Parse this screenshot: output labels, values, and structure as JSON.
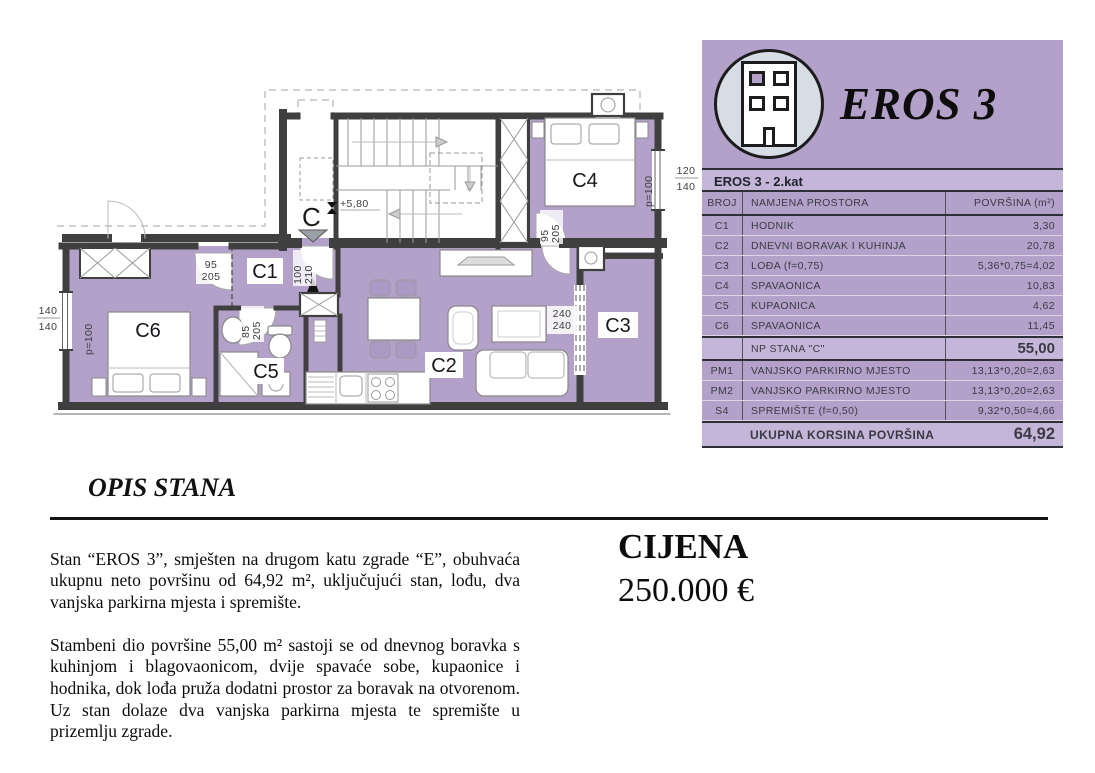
{
  "colors": {
    "purple": "#b3a1ca",
    "purple_light": "#c4b6d8",
    "wall": "#3f3f3f",
    "icon_circle_bg": "#d8dce5"
  },
  "floor_plan": {
    "room_labels": {
      "c1": "C1",
      "c2": "C2",
      "c3": "C3",
      "c4": "C4",
      "c5": "C5",
      "c6": "C6"
    },
    "entrance": {
      "letter": "C",
      "level": "+5,80"
    },
    "dims": {
      "c1_w": "95",
      "c1_h": "205",
      "entry_w": "100",
      "entry_h": "210",
      "c5_w": "85",
      "c5_h": "205",
      "c4_w": "95",
      "c4_h": "205",
      "c3_w": "240",
      "c3_h": "240",
      "win_left_a": "140",
      "win_left_b": "140",
      "win_right_a": "120",
      "win_right_b": "140",
      "p_left": "p=100",
      "p_right": "p=100"
    }
  },
  "panel": {
    "brand": "EROS 3",
    "subtitle": "EROS 3 - 2.kat",
    "table": {
      "headers": {
        "broj": "BROJ",
        "namjena": "NAMJENA PROSTORA",
        "povrsina": "POVRŠINA (m²)"
      },
      "rows": [
        {
          "broj": "C1",
          "namjena": "HODNIK",
          "povrsina": "3,30"
        },
        {
          "broj": "C2",
          "namjena": "DNEVNI BORAVAK I KUHINJA",
          "povrsina": "20,78"
        },
        {
          "broj": "C3",
          "namjena": "LOĐA (f=0,75)",
          "povrsina": "5,36*0,75=4,02"
        },
        {
          "broj": "C4",
          "namjena": "SPAVAONICA",
          "povrsina": "10,83"
        },
        {
          "broj": "C5",
          "namjena": "KUPAONICA",
          "povrsina": "4,62"
        },
        {
          "broj": "C6",
          "namjena": "SPAVAONICA",
          "povrsina": "11,45"
        }
      ],
      "subtotal": {
        "label": "NP STANA \"C\"",
        "value": "55,00"
      },
      "extras": [
        {
          "broj": "PM1",
          "namjena": "VANJSKO PARKIRNO MJESTO",
          "povrsina": "13,13*0,20=2,63"
        },
        {
          "broj": "PM2",
          "namjena": "VANJSKO PARKIRNO MJESTO",
          "povrsina": "13,13*0,20=2,63"
        },
        {
          "broj": "S4",
          "namjena": "SPREMIŠTE (f=0,50)",
          "povrsina": "9,32*0,50=4,66"
        }
      ],
      "total": {
        "label": "UKUPNA KORSINA POVRŠINA",
        "value": "64,92"
      }
    }
  },
  "description": {
    "heading": "OPIS STANA",
    "paragraphs": [
      "Stan “EROS 3”, smješten na drugom katu zgrade “E”, obuhvaća ukupnu neto površinu od 64,92 m², uključujući stan, lođu, dva vanjska parkirna mjesta i spremište.",
      "Stambeni dio površine 55,00 m² sastoji se od dnevnog boravka s kuhinjom i blagovaonicom, dvije spavaće sobe, kupaonice i hodnika, dok lođa pruža dodatni prostor za boravak na otvorenom. Uz stan dolaze dva vanjska parkirna mjesta te spremište u prizemlju zgrade."
    ]
  },
  "price": {
    "label": "CIJENA",
    "value": "250.000 €"
  }
}
